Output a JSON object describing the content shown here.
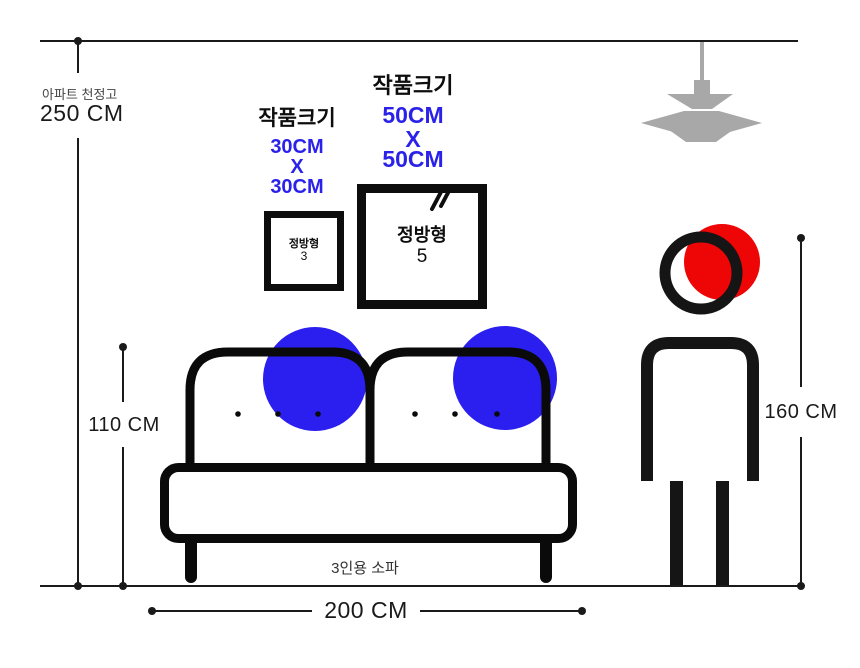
{
  "colors": {
    "blue_text": "#2a22e8",
    "blue_circle": "#2b1ff0",
    "red_circle": "#ee0505",
    "lamp_gray": "#a8a8a8",
    "ink": "#0d0d0d"
  },
  "ceiling": {
    "label": "아파트 천정고",
    "height": "250 CM"
  },
  "artworks": [
    {
      "title": "작품크기",
      "size_lines": [
        "30CM",
        "X",
        "30CM"
      ],
      "frame_label": "정방형",
      "frame_number": "3"
    },
    {
      "title": "작품크기",
      "size_lines": [
        "50CM",
        "X",
        "50CM"
      ],
      "frame_label": "정방형",
      "frame_number": "5"
    }
  ],
  "sofa": {
    "label": "3인용 소파",
    "width": "200 CM",
    "height": "110 CM"
  },
  "person": {
    "height": "160 CM"
  }
}
